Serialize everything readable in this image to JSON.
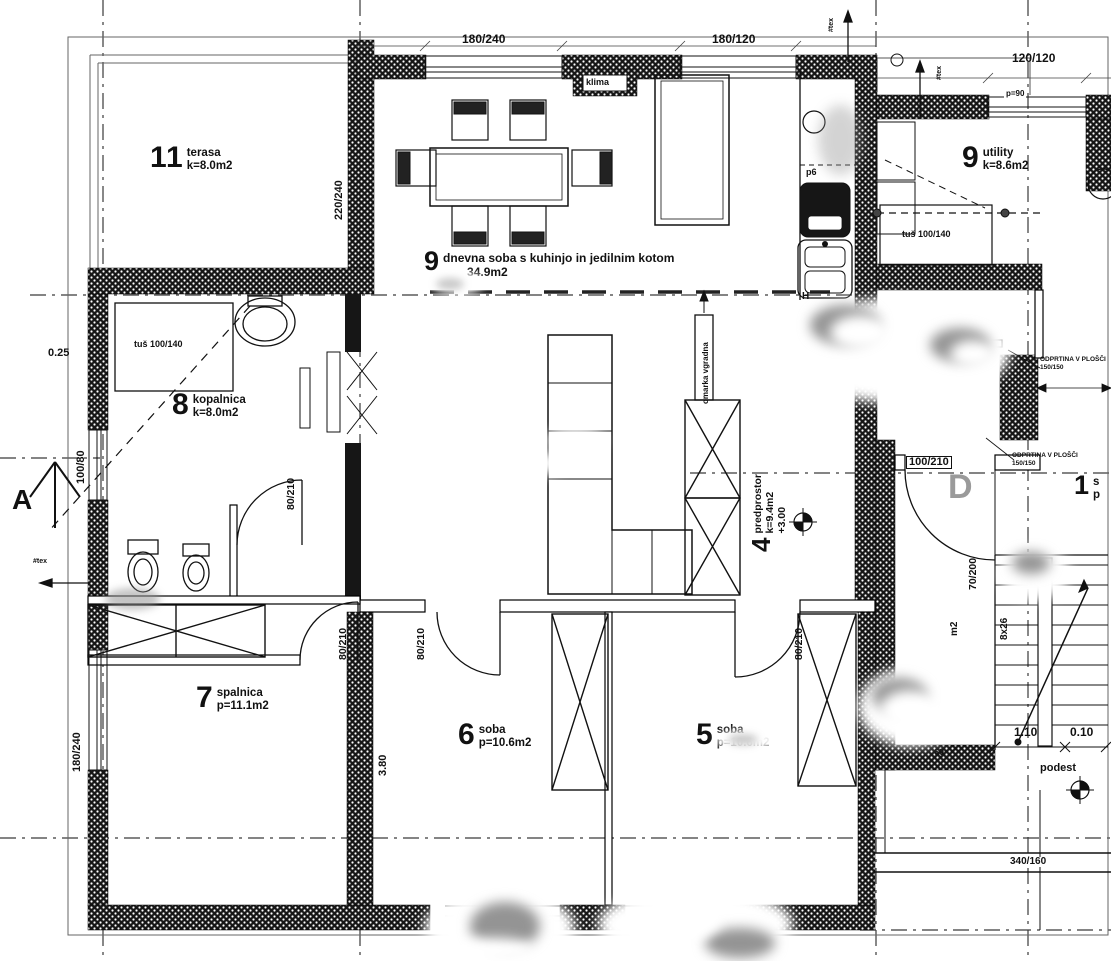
{
  "rooms": {
    "terasa": {
      "number": "11",
      "name": "terasa",
      "area": "k=8.0m2"
    },
    "living": {
      "number": "9",
      "name": "dnevna soba s kuhinjo in jedilnim kotom",
      "area": "34.9m2"
    },
    "utility": {
      "number": "9",
      "name": "utility",
      "area": "k=8.6m2"
    },
    "kopalnica": {
      "number": "8",
      "name": "kopalnica",
      "area": "k=8.0m2"
    },
    "spalnica": {
      "number": "7",
      "name": "spalnica",
      "area": "p=11.1m2"
    },
    "soba6": {
      "number": "6",
      "name": "soba",
      "area": "p=10.6m2"
    },
    "soba5": {
      "number": "5",
      "name": "soba",
      "area": "p=10.6m2"
    },
    "predprostor": {
      "number": "4",
      "name": "predprostor",
      "area": "k=9.4m2",
      "level": "+3.00"
    },
    "stopnisce": {
      "number": "1",
      "name": "s",
      "area": "p"
    }
  },
  "dimensions": {
    "window_top_1": "180/240",
    "window_top_2": "180/120",
    "window_utility": "120/120",
    "wall_terasa": "220/240",
    "window_left": "100/80",
    "window_left_2": "180/240",
    "offset_left": "0.25",
    "room6_depth": "3.80",
    "door_bath": "80/210",
    "door_room7": "80/210",
    "door_room6": "80/210",
    "door_room5": "80/210",
    "door_right": "100/210",
    "window_stair": "70/200",
    "stair_steps": "8x26",
    "stair_m2": "m2",
    "stair_run": "1.10",
    "stair_run2": "0.10",
    "podest": "podest",
    "wall_bottom_right": "340/160",
    "parapet": "p=90",
    "dim_60": "60"
  },
  "labels": {
    "klima": "klima",
    "shower_bath": "tuš 100/140",
    "shower_utility": "tuš 100/140",
    "cabinet_note": "omarka vgradna",
    "p6": "p6",
    "h_marker": "H",
    "d_marker": "D",
    "section_a": "A",
    "opening_note_1a": "ODPRTINA V PLOŠČI",
    "opening_note_1b": "150/150",
    "opening_note_2a": "ODPRTINA V PLOŠČI",
    "opening_note_2b": "150/150",
    "flue_1": "#tex",
    "flue_2": "#tex",
    "flue_3": "#tex"
  }
}
